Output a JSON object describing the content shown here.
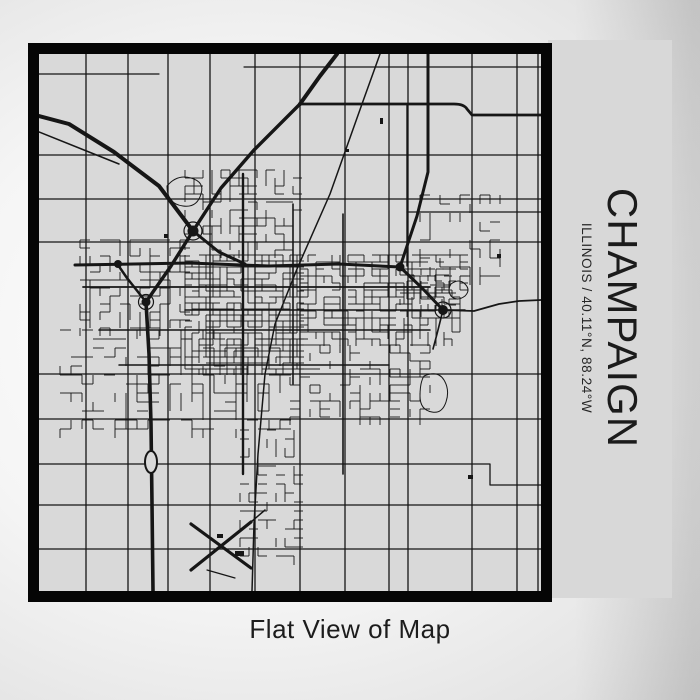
{
  "poster": {
    "title": "CHAMPAIGN",
    "subtitle": "ILLINOIS / 40.11°N, 88.24°W",
    "caption": "Flat View of Map"
  },
  "colors": {
    "map_background": "#d9d9d9",
    "street_line": "#161616",
    "frame_border": "#050505",
    "side_panel": "#d8d8d8",
    "text": "#1b1b1b"
  },
  "map": {
    "viewbox": "0 0 502 537",
    "grid": {
      "vertical": [
        47,
        89,
        129,
        171,
        216,
        261,
        306,
        350,
        369,
        433,
        478,
        499
      ],
      "horizontal": [
        101,
        145,
        188,
        320,
        365,
        451,
        495
      ],
      "width": 1.3
    },
    "roads": [
      {
        "d": "M0,62 L30,70 L75,98 L120,132 L154,177",
        "w": 4
      },
      {
        "d": "M0,78 L45,96 L80,110",
        "w": 1.5
      },
      {
        "d": "M298,0 L281,22 L261,50",
        "w": 4
      },
      {
        "d": "M261,50 L215,96 L182,134 L154,177",
        "w": 3.4
      },
      {
        "d": "M261,50 L415,50 Q425,50 428,55 L433,61 L502,61",
        "w": 2.8
      },
      {
        "d": "M341,0 L323,50 L291,140 L258,215 L236,270 L226,320 L219,400 L215,470 L213,537",
        "w": 1.5
      },
      {
        "d": "M36,211 L150,209 L230,212 L300,210 L361,213",
        "w": 3
      },
      {
        "d": "M154,177 L180,198 L206,210",
        "w": 3
      },
      {
        "d": "M154,177 L132,212 L107,248",
        "w": 3.4
      },
      {
        "d": "M107,248 L110,300 L112,370 L113,450 L114,537",
        "w": 3.6
      },
      {
        "d": "M107,248 L88,224 L79,211",
        "w": 2.5
      },
      {
        "d": "M389,0 L389,118 L378,162 L361,213",
        "w": 3
      },
      {
        "d": "M361,213 L383,234 L404,256",
        "w": 3
      },
      {
        "d": "M404,256 L435,257 L460,250 L480,247 L502,246",
        "w": 1.8
      },
      {
        "d": "M404,256 L398,280 L394,295",
        "w": 1.6
      },
      {
        "d": "M204,120 L204,420",
        "w": 2.4
      },
      {
        "d": "M254,150 L254,330",
        "w": 1.6
      },
      {
        "d": "M304,160 L304,420",
        "w": 1.6
      },
      {
        "d": "M368,50 L368,212",
        "w": 1.4
      },
      {
        "d": "M368,158 L502,158",
        "w": 1.3
      },
      {
        "d": "M205,13 L502,13",
        "w": 1.2
      },
      {
        "d": "M0,20 L120,20",
        "w": 1.2
      },
      {
        "d": "M44,233 L391,233",
        "w": 1.8
      },
      {
        "d": "M146,256 L426,256",
        "w": 1.6
      },
      {
        "d": "M60,276 L391,276",
        "w": 1.6
      },
      {
        "d": "M80,311 L350,311",
        "w": 1.5
      },
      {
        "d": "M0,410 L451,410 L451,431 L502,431",
        "w": 1.3
      },
      {
        "d": "M152,470 L212,514",
        "w": 3.2
      },
      {
        "d": "M152,516 L212,468",
        "w": 3.2
      },
      {
        "d": "M212,468 L226,456",
        "w": 1.5
      },
      {
        "d": "M168,516 L196,524",
        "w": 1.2
      }
    ],
    "clusters": [
      {
        "x": 146,
        "y": 201,
        "w": 115,
        "h": 115,
        "sx": 7,
        "sy": 6,
        "den": 0.72,
        "seed": 11
      },
      {
        "x": 261,
        "y": 201,
        "w": 165,
        "h": 90,
        "sx": 8,
        "sy": 7,
        "den": 0.55,
        "seed": 23
      },
      {
        "x": 41,
        "y": 186,
        "w": 105,
        "h": 90,
        "sx": 10,
        "sy": 8,
        "den": 0.42,
        "seed": 37
      },
      {
        "x": 21,
        "y": 276,
        "w": 230,
        "h": 100,
        "sx": 11,
        "sy": 9,
        "den": 0.35,
        "seed": 51
      },
      {
        "x": 251,
        "y": 291,
        "w": 140,
        "h": 75,
        "sx": 10,
        "sy": 8,
        "den": 0.4,
        "seed": 67
      },
      {
        "x": 146,
        "y": 116,
        "w": 115,
        "h": 85,
        "sx": 9,
        "sy": 8,
        "den": 0.45,
        "seed": 79
      },
      {
        "x": 381,
        "y": 141,
        "w": 80,
        "h": 90,
        "sx": 10,
        "sy": 9,
        "den": 0.3,
        "seed": 91
      },
      {
        "x": 201,
        "y": 376,
        "w": 60,
        "h": 130,
        "sx": 9,
        "sy": 9,
        "den": 0.28,
        "seed": 101
      },
      {
        "x": 361,
        "y": 215,
        "w": 55,
        "h": 45,
        "sx": 7,
        "sy": 6,
        "den": 0.5,
        "seed": 113
      }
    ],
    "knots": [
      {
        "cx": 154,
        "cy": 177,
        "r": 5.5,
        "ring": 9
      },
      {
        "cx": 107,
        "cy": 248,
        "r": 4.5,
        "ring": 7.5
      },
      {
        "cx": 79,
        "cy": 210,
        "r": 4
      },
      {
        "cx": 361,
        "cy": 213,
        "r": 4.5
      },
      {
        "cx": 404,
        "cy": 256,
        "r": 5,
        "ring": 8
      }
    ],
    "ovals": [
      {
        "cx": 112,
        "cy": 408,
        "rx": 6,
        "ry": 11
      }
    ],
    "ponds": [
      "M128,132 q10,-12 24,-8 q14,4 10,16 q-4,14 -18,12 q-16,-2 -16,-20 z",
      "M385,322 q14,-6 20,4 q6,10 2,22 q-4,12 -14,10 q-12,-2 -12,-16 q0,-14 4,-20 z",
      "M412,230 q8,-6 14,0 q6,6 0,12 q-8,6 -14,0 q-4,-6 0,-12 z"
    ],
    "blocks": [
      [
        429,
        421,
        5,
        4
      ],
      [
        341,
        64,
        3,
        6
      ],
      [
        125,
        180,
        4,
        4
      ],
      [
        306,
        95,
        4,
        3
      ],
      [
        458,
        200,
        4,
        4
      ],
      [
        196,
        497,
        9,
        5
      ],
      [
        178,
        480,
        6,
        4
      ]
    ]
  }
}
